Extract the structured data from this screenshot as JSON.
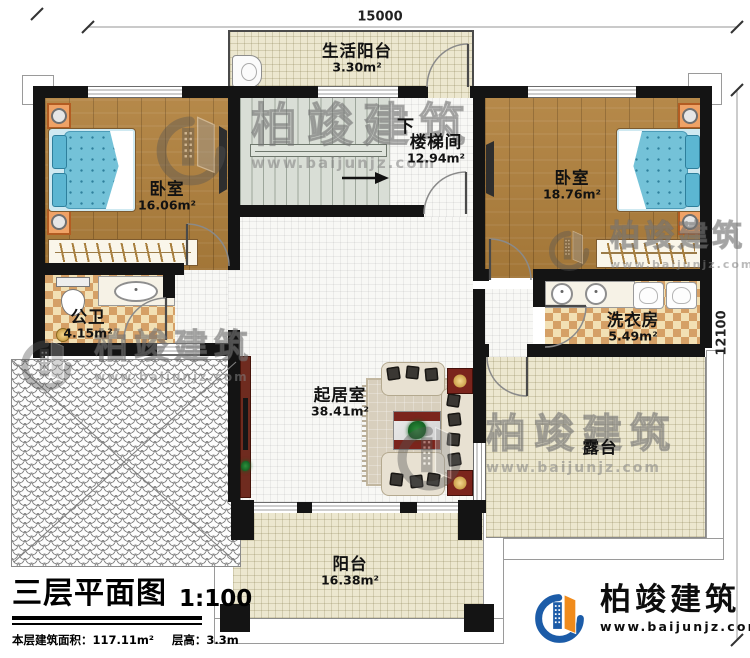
{
  "dimensions": {
    "top": "15000",
    "right": "12100"
  },
  "stairs": {
    "direction_label": "下"
  },
  "rooms": {
    "life_balcony": {
      "name": "生活阳台",
      "area": "3.30m²"
    },
    "stairwell": {
      "name": "楼梯间",
      "area": "12.94m²"
    },
    "bedroom_left": {
      "name": "卧室",
      "area": "16.06m²"
    },
    "bedroom_right": {
      "name": "卧室",
      "area": "18.76m²"
    },
    "bathroom": {
      "name": "公卫",
      "area": "4.15m²"
    },
    "laundry": {
      "name": "洗衣房",
      "area": "5.49m²"
    },
    "living_room": {
      "name": "起居室",
      "area": "38.41m²"
    },
    "terrace": {
      "name": "露台"
    },
    "balcony": {
      "name": "阳台",
      "area": "16.38m²"
    }
  },
  "title_block": {
    "title": "三层平面图",
    "scale": "1:100",
    "area_label": "本层建筑面积：",
    "area_value": "117.11m²",
    "height_label": "层高：",
    "height_value": "3.3m"
  },
  "brand": {
    "name": "柏竣建筑",
    "url": "www.baijunjz.com"
  },
  "icons": {
    "brand_mark": "building-swoosh-icon",
    "stair_arrow": "stair-direction-arrow"
  },
  "colors": {
    "wall": "#141414",
    "wood": "#b0803c",
    "tile_light": "#f2e0b4",
    "tile_dark": "#d5a066",
    "floor_beige": "#ece7cf",
    "stair_gray": "#d9ded6",
    "bed_blue": "#74c2d8",
    "furniture_red": "#7b241c",
    "logo_blue": "#1c5ca8",
    "logo_orange": "#f08b1c"
  }
}
